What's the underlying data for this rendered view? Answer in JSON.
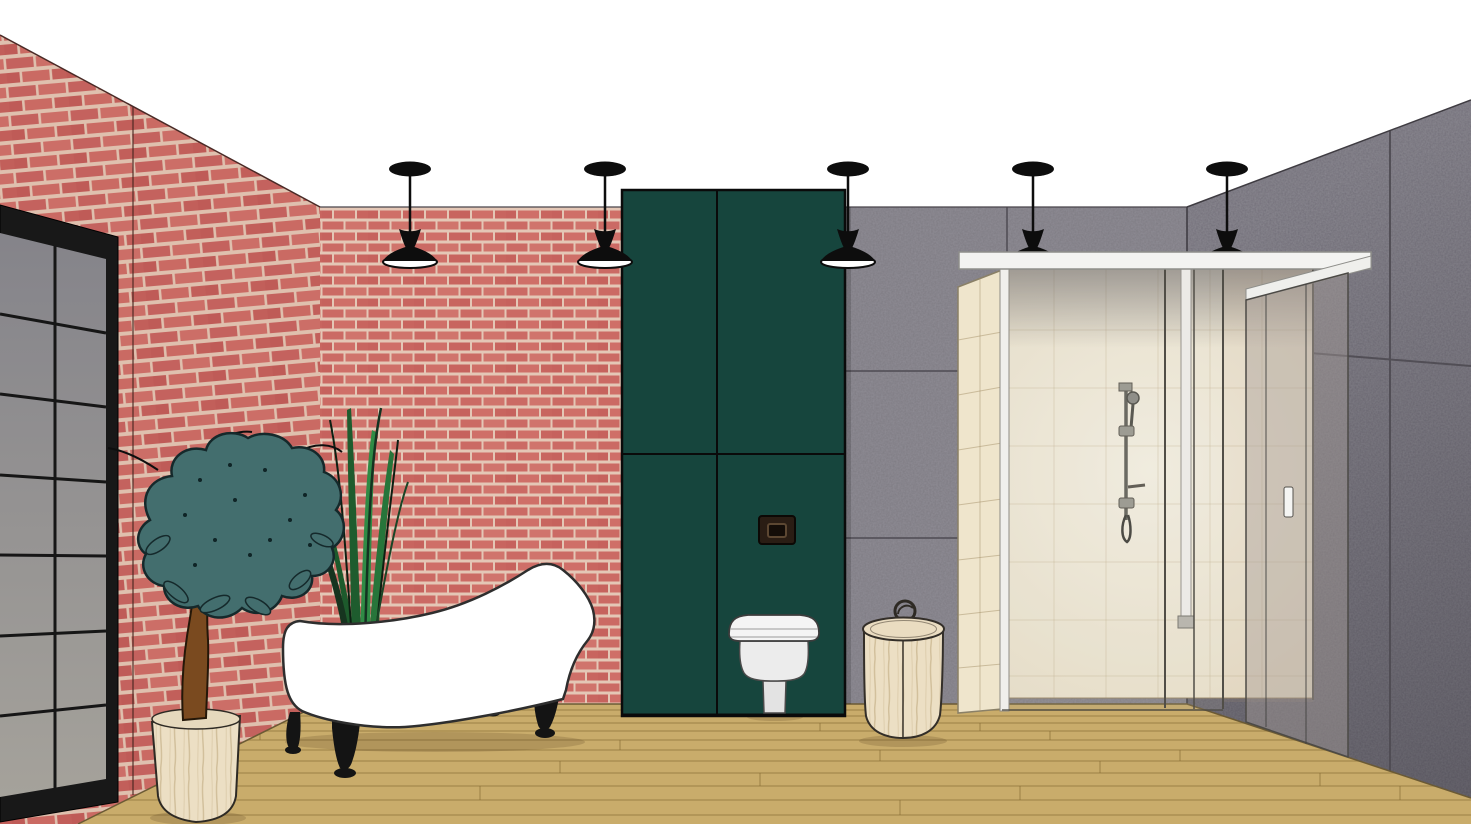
{
  "scene": {
    "description": "3D interior visualization of an industrial-style bathroom",
    "pendant_light_count": 5,
    "window_grid": "2 x 7 panes",
    "objects": [
      "black framed window",
      "red brick wall left",
      "red brick wall back",
      "gray panel wall back",
      "gray panel wall right",
      "pendant lights",
      "tall green cabinet",
      "flush plate",
      "wall-hung toilet",
      "white clawfoot bathtub",
      "potted tree",
      "grass plant",
      "lidded wooden basket",
      "walk-in glass shower",
      "shower slide rail",
      "wood plank floor"
    ]
  },
  "colors": {
    "ceiling": "#ffffff",
    "brick": "#cb6a64",
    "mortar": "#e4c7b6",
    "cabinet_green": "#16453d",
    "wall_gray_back": "#7d7a82",
    "wall_gray_right": "#716e78",
    "seam_dark": "#4e4b52",
    "floor_wood": "#c9ac6b",
    "plank_line": "#8c7038",
    "window_frame": "#181818",
    "window_pane": "#8e8d8a",
    "tub_white": "#ffffff",
    "outline_dark": "#2e2e2e",
    "foliage_teal": "#436e6e",
    "trunk_brown": "#7a4a1f",
    "grass_green": "#2f8b45",
    "wood_cream": "#ecdfc4",
    "tile_cream": "#f6efde",
    "header_white": "#f3f3f1",
    "flush_plate_brown": "#2a1d14",
    "toilet_white": "#f4f4f4",
    "pendant_black": "#0d0d0d",
    "chrome": "#6f6f68"
  }
}
